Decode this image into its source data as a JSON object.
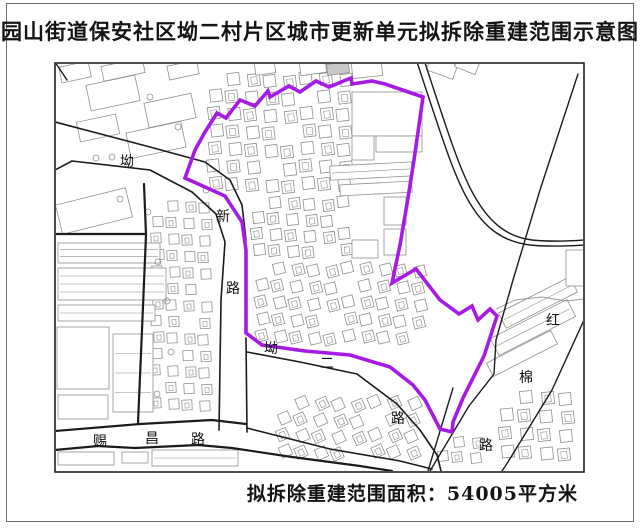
{
  "title": "园山街道保安社区坳二村片区城市更新单元拟拆除重建范围示意图",
  "caption": "拟拆除重建范围面积：54005平方米",
  "colors": {
    "boundary": "#a61ae6",
    "road": "#1b1b1b",
    "building_outline": "#8f8f8f",
    "building_fill": "#ffffff",
    "frame": "#222222",
    "label_text": "#111111",
    "stream": "#9a9a9a"
  },
  "map": {
    "frame": {
      "x": 55,
      "y": 63,
      "w": 529,
      "h": 409
    },
    "boundary": {
      "stroke_width": 3.6,
      "points": "205,132 217,113 226,118 240,100 255,106 268,91 270,97 289,86 300,92 316,81 329,87 351,78 352,84 372,81 385,84 423,97 414,160 408,198 400,245 392,283 416,269 440,300 459,314 472,306 478,320 490,309 497,316 484,356 476,372 463,398 453,422 452,432 440,429 425,400 413,385 390,367 350,355 305,351 262,345 246,333 246,250 242,222 225,196 185,178 195,150"
    },
    "roads": [
      {
        "name": "aoxin-rd-ne-edge",
        "pts": "55,122 150,147 205,162 230,180 242,205 246,240",
        "w": 1.6
      },
      {
        "name": "aoxin-rd-nw-edge",
        "pts": "55,170 72,161 150,170 192,192 216,214 225,242 221,300 219,430",
        "w": 1.6
      },
      {
        "name": "aoxin-rd-se-edge",
        "pts": "246,338 247,432",
        "w": 1.6
      },
      {
        "name": "block-boundary-v",
        "pts": "144,184 146,235 142,330 138,423",
        "w": 2.2
      },
      {
        "name": "block-boundary-h",
        "pts": "55,234 146,234",
        "w": 2.2
      },
      {
        "name": "cichang-rd-n-edge",
        "pts": "55,431 140,424 212,420 246,424",
        "w": 2.2
      },
      {
        "name": "cichang-rd-s-edge",
        "pts": "55,450 98,446 135,448 198,445 232,448 292,457 360,466 392,471",
        "w": 2.2
      },
      {
        "name": "cichang-rd-ext",
        "pts": "247,428 330,449 400,461 432,469",
        "w": 1.6
      },
      {
        "name": "aoer-rd-s-edge",
        "pts": "247,352 300,362 357,374 397,404 420,430 437,455 441,471",
        "w": 1.6
      },
      {
        "name": "junction-line",
        "pts": "453,388 428,471",
        "w": 1.4
      },
      {
        "name": "hongmian-rd-w-edge",
        "pts": "578,74 540,190 513,280 496,340 494,374 469,406 430,471",
        "w": 1.4
      },
      {
        "name": "hongmian-rd-e-edge",
        "pts": "584,320 552,390 508,462 502,471",
        "w": 1.4
      },
      {
        "name": "corner-line",
        "pts": "55,62 67,80",
        "w": 1.4
      }
    ],
    "curves": [
      {
        "name": "sweep-road-1",
        "d": "M417,62 C438,125 452,172 468,200 C485,230 505,242 530,245 C551,247 570,246 584,245",
        "w": 1.4
      },
      {
        "name": "sweep-road-2",
        "d": "M424,60 C445,123 459,170 475,197 C491,225 509,237 532,240 C552,242 571,241 584,240",
        "w": 1.4
      }
    ],
    "stream": {
      "pts": "496,309 515,300 542,297 566,301 584,299",
      "w": 0.9
    },
    "clusters": [
      {
        "name": "village-upper",
        "x": 209,
        "y": 74,
        "cols": 8,
        "rows": 7,
        "dx": 18.5,
        "dy": 17.5,
        "s": 12,
        "rot": -7
      },
      {
        "name": "village-upper-2",
        "x": 252,
        "y": 198,
        "cols": 6,
        "rows": 4,
        "dx": 17.5,
        "dy": 16,
        "s": 11,
        "rot": -7
      },
      {
        "name": "village-west-strip",
        "x": 152,
        "y": 202,
        "cols": 4,
        "rows": 13,
        "dx": 16,
        "dy": 16.5,
        "s": 10,
        "rot": -3
      },
      {
        "name": "village-lower-center",
        "x": 256,
        "y": 264,
        "cols": 10,
        "rows": 5,
        "dx": 17.5,
        "dy": 17,
        "s": 11,
        "rot": -14
      },
      {
        "name": "village-south",
        "x": 278,
        "y": 398,
        "cols": 8,
        "rows": 4,
        "dx": 18.5,
        "dy": 16.5,
        "s": 11,
        "rot": -24
      },
      {
        "name": "village-southeast",
        "x": 500,
        "y": 392,
        "cols": 4,
        "rows": 4,
        "dx": 20,
        "dy": 18.5,
        "s": 12,
        "rot": -6
      },
      {
        "name": "village-junction",
        "x": 437,
        "y": 438,
        "cols": 3,
        "rows": 2,
        "dx": 17,
        "dy": 15,
        "s": 10,
        "rot": -6
      }
    ],
    "buildings": [
      {
        "x": 88,
        "y": 80,
        "w": 50,
        "h": 26,
        "rot": -12,
        "lines": 0
      },
      {
        "x": 146,
        "y": 98,
        "w": 48,
        "h": 25,
        "rot": -12,
        "lines": 0
      },
      {
        "x": 78,
        "y": 118,
        "w": 40,
        "h": 20,
        "rot": -12,
        "lines": 0
      },
      {
        "x": 128,
        "y": 127,
        "w": 56,
        "h": 26,
        "rot": -12,
        "lines": 0
      },
      {
        "x": 60,
        "y": 64,
        "w": 30,
        "h": 16,
        "rot": -12,
        "lines": 0
      },
      {
        "x": 102,
        "y": 62,
        "w": 42,
        "h": 15,
        "rot": -12,
        "lines": 0
      },
      {
        "x": 168,
        "y": 63,
        "w": 30,
        "h": 14,
        "rot": -12,
        "lines": 0
      },
      {
        "x": 58,
        "y": 196,
        "w": 72,
        "h": 30,
        "rot": -14,
        "lines": 0
      },
      {
        "x": 58,
        "y": 243,
        "w": 102,
        "h": 20,
        "rot": 0,
        "lines": 2
      },
      {
        "x": 58,
        "y": 268,
        "w": 108,
        "h": 32,
        "rot": 0,
        "lines": 3
      },
      {
        "x": 58,
        "y": 305,
        "w": 97,
        "h": 16,
        "rot": 0,
        "lines": 1
      },
      {
        "x": 57,
        "y": 327,
        "w": 52,
        "h": 62,
        "rot": 0,
        "lines": 0
      },
      {
        "x": 113,
        "y": 334,
        "w": 40,
        "h": 78,
        "rot": 0,
        "lines": 3
      },
      {
        "x": 58,
        "y": 395,
        "w": 50,
        "h": 24,
        "rot": 0,
        "lines": 0
      },
      {
        "x": 58,
        "y": 452,
        "w": 56,
        "h": 13,
        "rot": 0,
        "lines": 0
      },
      {
        "x": 122,
        "y": 452,
        "w": 26,
        "h": 11,
        "rot": 0,
        "lines": 0
      },
      {
        "x": 152,
        "y": 450,
        "w": 86,
        "h": 16,
        "rot": 0,
        "lines": 1
      },
      {
        "x": 352,
        "y": 92,
        "w": 70,
        "h": 44,
        "rot": 0,
        "lines": 0
      },
      {
        "x": 376,
        "y": 136,
        "w": 46,
        "h": 16,
        "rot": 0,
        "lines": 0
      },
      {
        "x": 352,
        "y": 136,
        "w": 22,
        "h": 24,
        "rot": 0,
        "lines": 0
      },
      {
        "x": 330,
        "y": 164,
        "w": 82,
        "h": 14,
        "rot": -3,
        "lines": 1
      },
      {
        "x": 340,
        "y": 183,
        "w": 72,
        "h": 11,
        "rot": -3,
        "lines": 0
      },
      {
        "x": 384,
        "y": 197,
        "w": 22,
        "h": 28,
        "rot": 0,
        "lines": 0
      },
      {
        "x": 384,
        "y": 229,
        "w": 22,
        "h": 26,
        "rot": 0,
        "lines": 0
      },
      {
        "x": 352,
        "y": 240,
        "w": 26,
        "h": 18,
        "rot": 0,
        "lines": 0
      },
      {
        "x": 498,
        "y": 294,
        "w": 80,
        "h": 17,
        "rot": -27,
        "lines": 1
      },
      {
        "x": 490,
        "y": 318,
        "w": 86,
        "h": 19,
        "rot": -27,
        "lines": 1
      },
      {
        "x": 486,
        "y": 346,
        "w": 72,
        "h": 15,
        "rot": -27,
        "lines": 0
      },
      {
        "x": 566,
        "y": 250,
        "w": 18,
        "h": 36,
        "rot": 0,
        "lines": 0
      },
      {
        "x": 428,
        "y": 60,
        "w": 28,
        "h": 15,
        "rot": 20,
        "lines": 0
      },
      {
        "x": 456,
        "y": 59,
        "w": 22,
        "h": 12,
        "rot": 22,
        "lines": 0
      },
      {
        "x": 255,
        "y": 62,
        "w": 20,
        "h": 12,
        "rot": -8,
        "lines": 0
      },
      {
        "x": 300,
        "y": 61,
        "w": 26,
        "h": 13,
        "rot": -8,
        "lines": 0
      },
      {
        "x": 327,
        "y": 63,
        "w": 22,
        "h": 11,
        "rot": -8,
        "lines": 0,
        "fill": "#c8c8c8"
      },
      {
        "x": 352,
        "y": 62,
        "w": 30,
        "h": 15,
        "rot": -6,
        "lines": 0
      }
    ],
    "circles": [
      {
        "x": 150,
        "y": 97
      },
      {
        "x": 178,
        "y": 127
      },
      {
        "x": 112,
        "y": 157
      },
      {
        "x": 96,
        "y": 158
      },
      {
        "x": 120,
        "y": 199
      },
      {
        "x": 148,
        "y": 212
      },
      {
        "x": 158,
        "y": 262
      },
      {
        "x": 167,
        "y": 301
      },
      {
        "x": 171,
        "y": 352
      },
      {
        "x": 157,
        "y": 394
      },
      {
        "x": 206,
        "y": 190
      }
    ],
    "labels": [
      {
        "t": "坳",
        "x": 127,
        "y": 162
      },
      {
        "t": "新",
        "x": 223,
        "y": 217
      },
      {
        "t": "路",
        "x": 233,
        "y": 289
      },
      {
        "t": "赐",
        "x": 100,
        "y": 442
      },
      {
        "t": "昌",
        "x": 152,
        "y": 439
      },
      {
        "t": "路",
        "x": 198,
        "y": 440
      },
      {
        "t": "坳",
        "x": 271,
        "y": 349
      },
      {
        "t": "二",
        "x": 327,
        "y": 364
      },
      {
        "t": "路",
        "x": 398,
        "y": 419
      },
      {
        "t": "红",
        "x": 553,
        "y": 321
      },
      {
        "t": "棉",
        "x": 526,
        "y": 378
      },
      {
        "t": "路",
        "x": 486,
        "y": 446
      }
    ],
    "label_font_size": 14
  }
}
